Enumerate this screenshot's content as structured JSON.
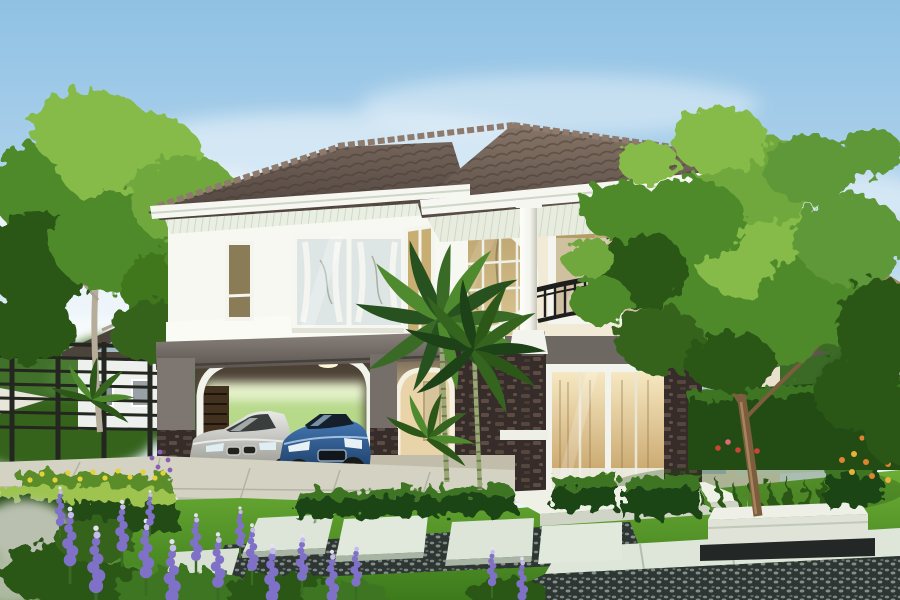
{
  "meta": {
    "kind": "architectural-exterior-rendering",
    "subject": "two-story suburban house with carport, balcony, palm trees and landscaped front garden",
    "width_px": 900,
    "height_px": 600
  },
  "palette": {
    "sky_top": "#8fc1e4",
    "sky_mid": "#c6dff0",
    "sky_horizon": "#eef5f9",
    "cloud": "#ffffff",
    "roof_light": "#877567",
    "roof_dark": "#574b45",
    "roof_ridge": "#8e7b6e",
    "fascia_white": "#f5f7f0",
    "soffit": "#e7ecdf",
    "wall_white": "#f7f8f2",
    "wall_cream": "#f1ead6",
    "under_balcony_wall": "#e9e1cd",
    "accent_band_gray": "#6b655f",
    "dark_wall_taupe": "#6f6861",
    "stone_dark": "#362c29",
    "stone_light": "#6e5a4e",
    "column_white": "#f4f4ee",
    "railing_black": "#1e1e1e",
    "glass_amber": "#cdb47e",
    "glass_amber_dark": "#94805a",
    "glass_cool": "#dde6e4",
    "door_glow": "#f6e8c2",
    "carport_beam": "#7d7671",
    "carport_inner": "#efdcb4",
    "gate_brown": "#43311f",
    "driveway": "#d4d2c3",
    "curb_dark": "#52524a",
    "lawn_light": "#6cae35",
    "lawn_dark": "#3c7a1c",
    "hedge_dark": "#234c15",
    "hedge_mid": "#3c7423",
    "hedge_top": "#9ec44f",
    "pebble_dark": "#2e3633",
    "slab_light": "#dde6d8",
    "planter_white": "#eef0e8",
    "tree_trunk": "#7c5d3e",
    "left_tree_trunk": "#b5ac9a",
    "palm_trunk": "#9aa877",
    "palm_frond_dark": "#27521f",
    "palm_frond_light": "#4f8a2e",
    "foliage_dark": "#2c5719",
    "foliage_mid": "#4f8a2b",
    "foliage_light": "#86bb4a",
    "flower_purple": "#8071c8",
    "flower_purple_light": "#c4bce8",
    "flower_yellow": "#e4d23a",
    "flower_orange": "#e0832f",
    "flower_red": "#cc4433",
    "silver_foliage": "#b9c0af",
    "car_silver_light": "#eceum",
    "car_silver_body": "#e9e9e7",
    "car_silver_shade": "#96968f",
    "car_blue_body": "#4579b5",
    "car_blue_shade": "#1c3c63",
    "tire_black": "#191919",
    "fence_dark": "#23271f",
    "neighbor_wall": "#edf0ec",
    "neighbor_accent": "#a2b9c1",
    "neighbor_roof": "#4c443c",
    "bg_house_roof_tan": "#a38a64"
  },
  "icons": {
    "tulip_emblem_glyph": "⚜"
  },
  "scene": {
    "sky": "light blue sky with soft white cloud streaks",
    "background": [
      "neighboring house on left behind black metal fence",
      "neighboring roof on right behind large tree",
      "green shrub line"
    ],
    "house": {
      "roof": "dark taupe concrete-tile hip roof with white fascia and striped soffit",
      "left_wing": "white second storey over double carport with arched openings",
      "center": "two-storey amber glass atrium with circular white window motif",
      "right_wing": "balcony with black wrought railing, curved white base, gray accent band with emblems",
      "entrance": "white-framed glass sliding doors with warm interior light, flanked by dark stone-clad pillars",
      "columns": "two round white columns supporting the right-wing eaves"
    },
    "vehicles": [
      "silver sedan parked in carport",
      "blue sports coupe parked in carport"
    ],
    "garden": [
      "green lawn",
      "pale stepping slabs with dark pebble joints",
      "white stone planter under large tree",
      "trimmed box hedges",
      "purple lupine flowers",
      "yellow, orange and red flower accents",
      "two areca palms",
      "large leafy tree",
      "silver foliage clumps"
    ]
  }
}
